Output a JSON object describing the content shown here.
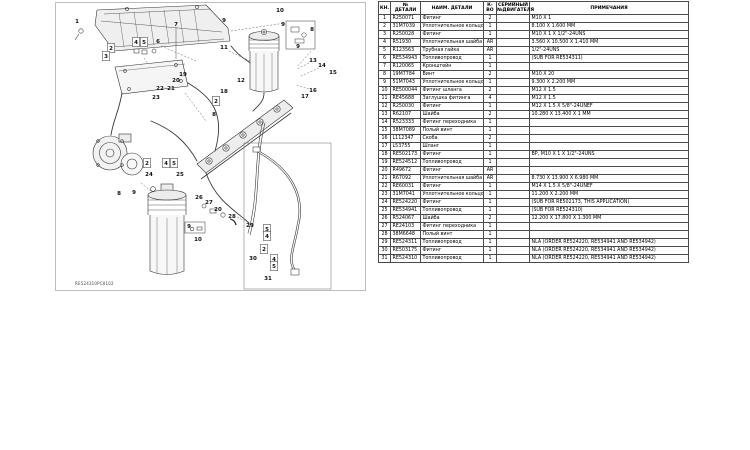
{
  "diagram": {
    "caption": "RE524310PC0102",
    "line_color": "#333333",
    "panel_border_color": "#bdbdbd",
    "callouts": [
      {
        "n": "1",
        "x": 76,
        "y": 20
      },
      {
        "n": "2",
        "x": 110,
        "y": 47,
        "boxed": true
      },
      {
        "n": "3",
        "x": 105,
        "y": 55,
        "boxed": true
      },
      {
        "n": "4",
        "x": 135,
        "y": 41,
        "boxed": true
      },
      {
        "n": "5",
        "x": 143,
        "y": 41,
        "boxed": true
      },
      {
        "n": "6",
        "x": 157,
        "y": 40
      },
      {
        "n": "7",
        "x": 175,
        "y": 23
      },
      {
        "n": "9",
        "x": 223,
        "y": 19
      },
      {
        "n": "10",
        "x": 279,
        "y": 9
      },
      {
        "n": "9",
        "x": 282,
        "y": 23
      },
      {
        "n": "8",
        "x": 311,
        "y": 28
      },
      {
        "n": "9",
        "x": 297,
        "y": 45
      },
      {
        "n": "11",
        "x": 223,
        "y": 46
      },
      {
        "n": "12",
        "x": 240,
        "y": 79
      },
      {
        "n": "13",
        "x": 312,
        "y": 59
      },
      {
        "n": "14",
        "x": 321,
        "y": 64
      },
      {
        "n": "15",
        "x": 332,
        "y": 71
      },
      {
        "n": "16",
        "x": 312,
        "y": 89
      },
      {
        "n": "17",
        "x": 304,
        "y": 95
      },
      {
        "n": "18",
        "x": 223,
        "y": 90
      },
      {
        "n": "2",
        "x": 215,
        "y": 100,
        "boxed": true
      },
      {
        "n": "8",
        "x": 213,
        "y": 113
      },
      {
        "n": "19",
        "x": 182,
        "y": 73
      },
      {
        "n": "20",
        "x": 175,
        "y": 79
      },
      {
        "n": "21",
        "x": 170,
        "y": 87
      },
      {
        "n": "22",
        "x": 159,
        "y": 87
      },
      {
        "n": "23",
        "x": 155,
        "y": 96
      },
      {
        "n": "24",
        "x": 148,
        "y": 173
      },
      {
        "n": "2",
        "x": 146,
        "y": 162,
        "boxed": true
      },
      {
        "n": "4",
        "x": 165,
        "y": 162,
        "boxed": true
      },
      {
        "n": "5",
        "x": 173,
        "y": 162,
        "boxed": true
      },
      {
        "n": "25",
        "x": 179,
        "y": 173
      },
      {
        "n": "8",
        "x": 118,
        "y": 192
      },
      {
        "n": "9",
        "x": 133,
        "y": 191
      },
      {
        "n": "26",
        "x": 198,
        "y": 196
      },
      {
        "n": "27",
        "x": 208,
        "y": 201
      },
      {
        "n": "20",
        "x": 217,
        "y": 208
      },
      {
        "n": "28",
        "x": 231,
        "y": 215
      },
      {
        "n": "9",
        "x": 188,
        "y": 225
      },
      {
        "n": "10",
        "x": 197,
        "y": 238
      },
      {
        "n": "29",
        "x": 249,
        "y": 224
      },
      {
        "n": "5",
        "x": 266,
        "y": 228,
        "boxed": true
      },
      {
        "n": "4",
        "x": 266,
        "y": 235,
        "boxed": true
      },
      {
        "n": "2",
        "x": 263,
        "y": 248,
        "boxed": true
      },
      {
        "n": "30",
        "x": 252,
        "y": 257
      },
      {
        "n": "4",
        "x": 273,
        "y": 258,
        "boxed": true
      },
      {
        "n": "5",
        "x": 273,
        "y": 265,
        "boxed": true
      },
      {
        "n": "31",
        "x": 267,
        "y": 277
      }
    ]
  },
  "table": {
    "columns": [
      {
        "key": "num",
        "label": "КН."
      },
      {
        "key": "part",
        "label": "№\nДЕТАЛИ"
      },
      {
        "key": "name",
        "label": "НАИМ. ДЕТАЛИ"
      },
      {
        "key": "qty",
        "label": "К-\nВО"
      },
      {
        "key": "serial",
        "label": "СЕРИЙНЫЙ\n№ДВИГАТЕЛЯ"
      },
      {
        "key": "remarks",
        "label": "ПРИМЕЧАНИЯ"
      }
    ],
    "rows": [
      {
        "num": "1",
        "part": "R250071",
        "name": "Фитинг",
        "qty": "2",
        "serial": "",
        "remarks": "M10 X 1"
      },
      {
        "num": "2",
        "part": "31M7039",
        "name": "Уплотнительное кольцо",
        "qty": "1",
        "serial": "",
        "remarks": "8.100 X 1.600 MM"
      },
      {
        "num": "3",
        "part": "R250028",
        "name": "Фитинг",
        "qty": "1",
        "serial": "",
        "remarks": "M10 X 1 X 1/2\"-24UNS"
      },
      {
        "num": "4",
        "part": "R51930",
        "name": "Уплотнительная шайба",
        "qty": "AR",
        "serial": "",
        "remarks": "3.560 X 10.500 X 1.410 MM"
      },
      {
        "num": "5",
        "part": "R123563",
        "name": "Трубная гайка",
        "qty": "AR",
        "serial": "",
        "remarks": "1/2\"-24UNS"
      },
      {
        "num": "6",
        "part": "RE534943",
        "name": "Топливопровод",
        "qty": "1",
        "serial": "",
        "remarks": "(SUB FOR RE534311)"
      },
      {
        "num": "7",
        "part": "R120065",
        "name": "Кронштейн",
        "qty": "1",
        "serial": "",
        "remarks": ""
      },
      {
        "num": "8",
        "part": "19M7784",
        "name": "Винт",
        "qty": "2",
        "serial": "",
        "remarks": "M10 X 20"
      },
      {
        "num": "9",
        "part": "51M7043",
        "name": "Уплотнительное кольцо",
        "qty": "1",
        "serial": "",
        "remarks": "9.300 X 2.200 MM"
      },
      {
        "num": "10",
        "part": "RE500044",
        "name": "Фитинг шланга",
        "qty": "2",
        "serial": "",
        "remarks": "M12 X 1.5"
      },
      {
        "num": "11",
        "part": "RE45688",
        "name": "Заглушка фитинга",
        "qty": "4",
        "serial": "",
        "remarks": "M12 X 1.5"
      },
      {
        "num": "12",
        "part": "R250030",
        "name": "Фитинг",
        "qty": "1",
        "serial": "",
        "remarks": "M12 X 1.5 X 5/8\"-24UNEF"
      },
      {
        "num": "13",
        "part": "R62107",
        "name": "Шайба",
        "qty": "2",
        "serial": "",
        "remarks": "10.280 X 13.400 X 1 MM"
      },
      {
        "num": "14",
        "part": "R523333",
        "name": "Фитинг переходника",
        "qty": "1",
        "serial": "",
        "remarks": ""
      },
      {
        "num": "15",
        "part": "38M7089",
        "name": "Полый винт",
        "qty": "1",
        "serial": "",
        "remarks": ""
      },
      {
        "num": "16",
        "part": "L112347",
        "name": "Скоба",
        "qty": "2",
        "serial": "",
        "remarks": ""
      },
      {
        "num": "17",
        "part": "L53755",
        "name": "Шланг",
        "qty": "1",
        "serial": "",
        "remarks": ""
      },
      {
        "num": "18",
        "part": "RE502173",
        "name": "Фитинг",
        "qty": "1",
        "serial": "",
        "remarks": "BP, M10 X 1 X 1/2\"-24UNS"
      },
      {
        "num": "19",
        "part": "RE524512",
        "name": "Топливопровод",
        "qty": "1",
        "serial": "",
        "remarks": ""
      },
      {
        "num": "20",
        "part": "R49672",
        "name": "Фитинг",
        "qty": "AR",
        "serial": "",
        "remarks": ""
      },
      {
        "num": "21",
        "part": "R67092",
        "name": "Уплотнительная шайба",
        "qty": "AR",
        "serial": "",
        "remarks": "8.730 X 13.900 X 6.980 MM"
      },
      {
        "num": "22",
        "part": "RE60031",
        "name": "Фитинг",
        "qty": "1",
        "serial": "",
        "remarks": "M14 X 1.5 X 5/8\"-24UNEF"
      },
      {
        "num": "23",
        "part": "31M7041",
        "name": "Уплотнительное кольцо",
        "qty": "1",
        "serial": "",
        "remarks": "11.200 X 2.200 MM"
      },
      {
        "num": "24",
        "part": "RE524220",
        "name": "Фитинг",
        "qty": "1",
        "serial": "",
        "remarks": "(SUB FOR RE502173, THIS APPLICATION)"
      },
      {
        "num": "25",
        "part": "RE534941",
        "name": "Топливопровод",
        "qty": "1",
        "serial": "",
        "remarks": "(SUB FOR RE524310)"
      },
      {
        "num": "26",
        "part": "R524067",
        "name": "Шайба",
        "qty": "2",
        "serial": "",
        "remarks": "12.200 X 17.800 X 1.300 MM"
      },
      {
        "num": "27",
        "part": "RE24103",
        "name": "Фитинг переходника",
        "qty": "1",
        "serial": "",
        "remarks": ""
      },
      {
        "num": "28",
        "part": "38M6648",
        "name": "Полый винт",
        "qty": "1",
        "serial": "",
        "remarks": ""
      },
      {
        "num": "29",
        "part": "RE524311",
        "name": "Топливопровод",
        "qty": "1",
        "serial": "",
        "remarks": "NLA (ORDER RE524220, RE534941 AND RE534942)"
      },
      {
        "num": "30",
        "part": "RE503175",
        "name": "Фитинг",
        "qty": "1",
        "serial": "",
        "remarks": "NLA (ORDER RE524220, RE534941 AND RE534942)"
      },
      {
        "num": "31",
        "part": "RE524310",
        "name": "Топливопровод",
        "qty": "1",
        "serial": "",
        "remarks": "NLA (ORDER RE524220, RE534941 AND RE534942)"
      }
    ]
  }
}
